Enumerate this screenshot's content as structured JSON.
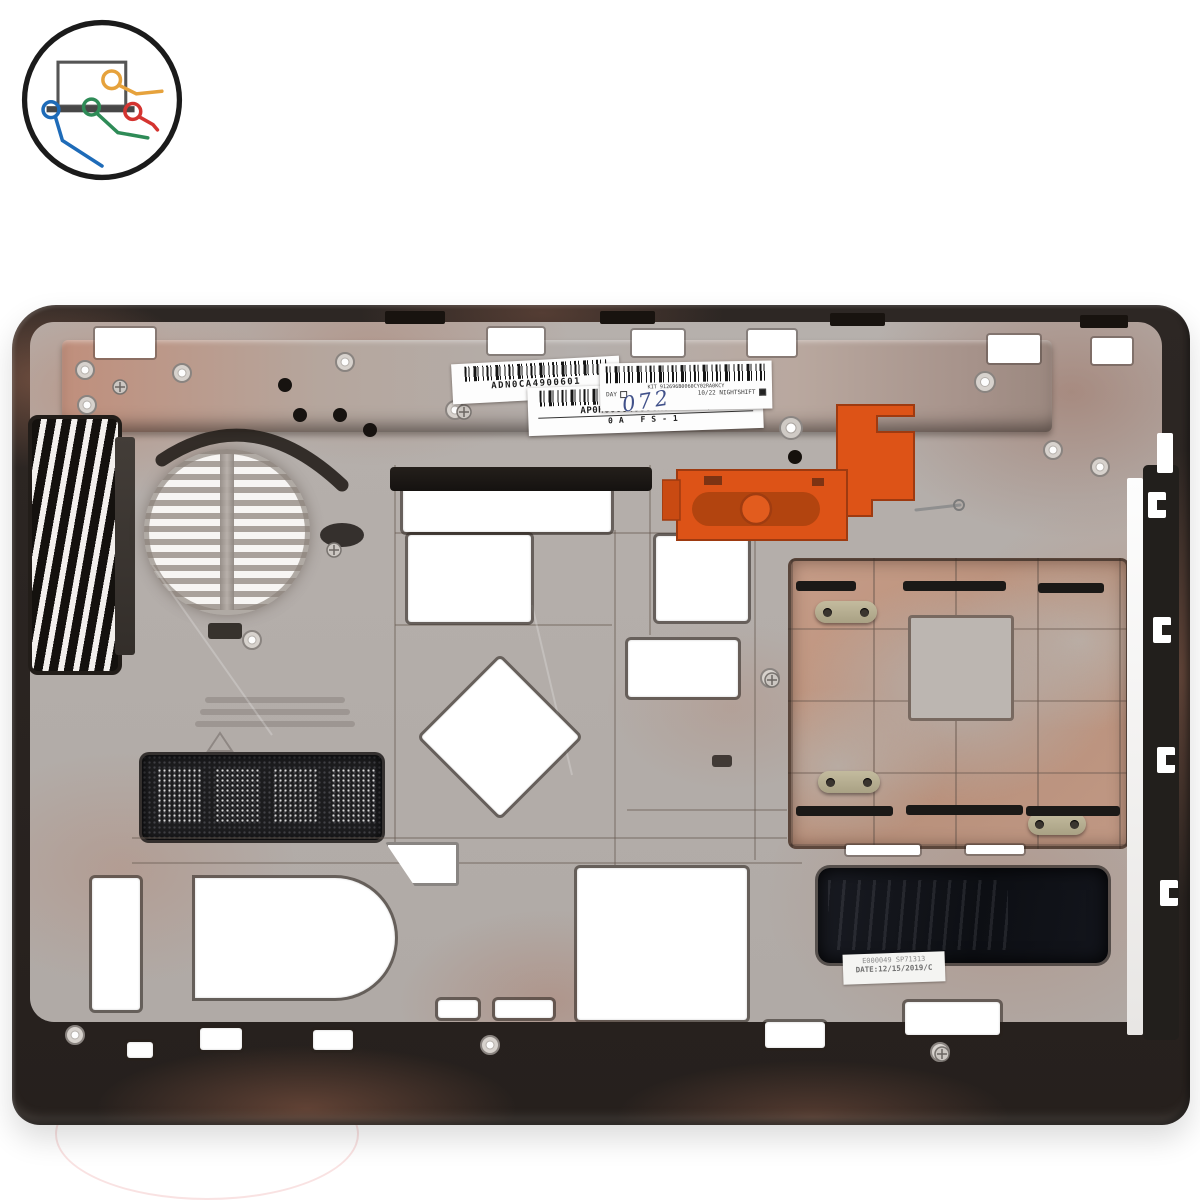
{
  "logo": {
    "icon": "laptop-with-cables-icon",
    "colors": {
      "outline": "#1b1b1b",
      "laptop": "#555555",
      "cable_orange": "#e6a23c",
      "cable_green": "#2e8b57",
      "cable_blue": "#1e6bb8",
      "cable_red": "#d43430"
    }
  },
  "part_photo": {
    "subject": "laptop-bottom-case",
    "colors": {
      "plastic_rim": "#2c2623",
      "magnesium_floor": "#b4aeaa",
      "copper_staining": "#bb826a",
      "battery_latch_orange": "#dd5317",
      "thermal_pad_black": "#101218",
      "label_white": "#fdfdfd"
    }
  },
  "labels": {
    "barcode_label_1": {
      "text": "ADN0CA4900601"
    },
    "barcode_label_2": {
      "line1": "AP0HO0004000CK000737YQ",
      "line2": "0A    FS-1"
    },
    "kit_label": {
      "line1": "KIT 912696B0060CY02RA0KCY",
      "day": "DAY",
      "shift": "10/22 NIGHTSHIFT"
    },
    "handwritten_number": "072",
    "date_label": {
      "line1": "E000049 SP71313",
      "line2": "DATE:12/15/2019/C"
    }
  }
}
